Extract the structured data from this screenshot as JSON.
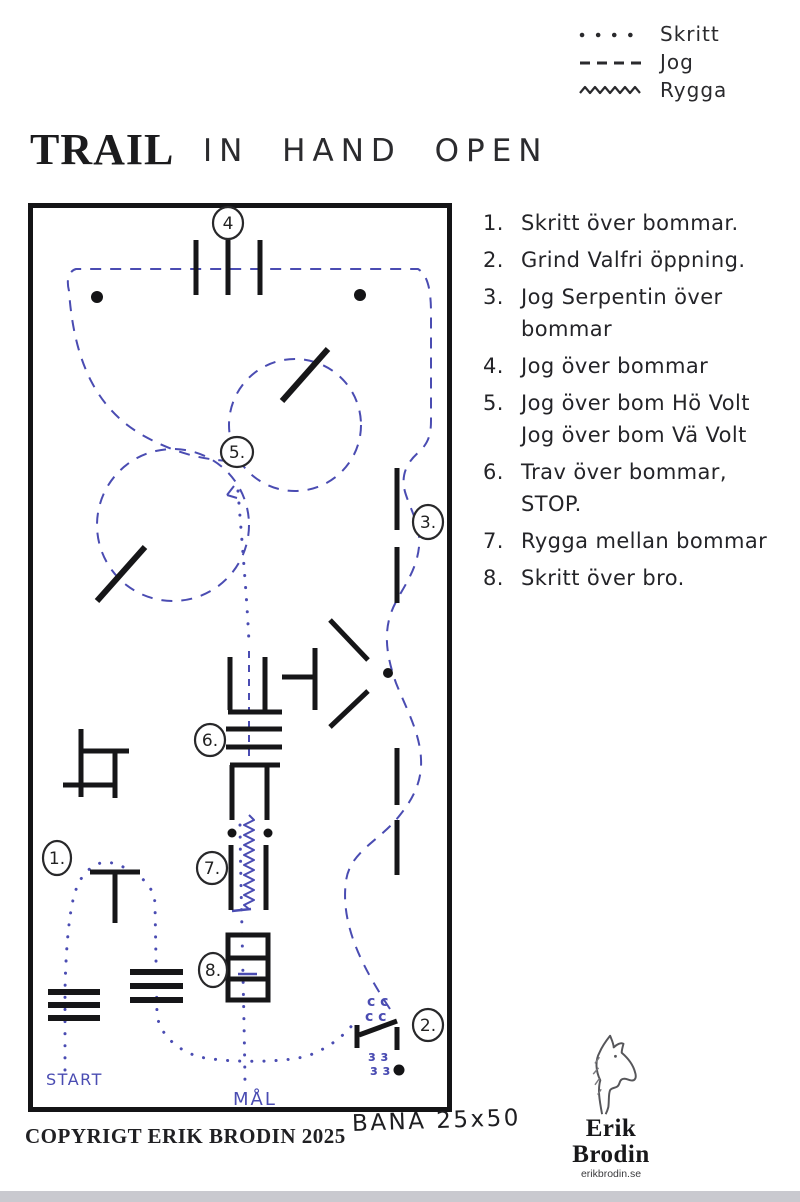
{
  "colors": {
    "ink": "#1c1c1e",
    "blue_ink": "#4a4cb2"
  },
  "legend": {
    "items": [
      {
        "label": "Skritt",
        "symbol": "dotted-line"
      },
      {
        "label": "Jog",
        "symbol": "dashed-line"
      },
      {
        "label": "Rygga",
        "symbol": "zigzag-line"
      }
    ]
  },
  "header": {
    "title": "TRAIL",
    "subtitle": "IN HAND OPEN"
  },
  "obstacles": {
    "items": [
      {
        "num": "1.",
        "text": "Skritt över bommar."
      },
      {
        "num": "2.",
        "text": "Grind Valfri öppning."
      },
      {
        "num": "3.",
        "text": "Jog Serpentin över\nbommar"
      },
      {
        "num": "4.",
        "text": "Jog över bommar"
      },
      {
        "num": "5.",
        "text": "Jog över bom Hö Volt\nJog över bom Vä Volt"
      },
      {
        "num": "6.",
        "text": "Trav över bommar,\nSTOP."
      },
      {
        "num": "7.",
        "text": "Rygga mellan bommar"
      },
      {
        "num": "8.",
        "text": "Skritt över bro."
      }
    ]
  },
  "arena": {
    "markers": {
      "m1": "1.",
      "m2": "2.",
      "m3": "3.",
      "m4": "4",
      "m5": "5.",
      "m6": "6.",
      "m7": "7.",
      "m8": "8."
    },
    "start_label": "START",
    "goal_label": "MÅL",
    "gate_marks": {
      "row1": "c c",
      "row2": "c c",
      "row3": "ɜ ɜ",
      "row4": "ɜ ɜ"
    }
  },
  "footer": {
    "copyright": "COPYRIGT ERIK BRODIN 2025",
    "bana": "BANA 25x50",
    "logo_name": "Erik Brodin",
    "logo_site": "erikbrodin.se"
  }
}
